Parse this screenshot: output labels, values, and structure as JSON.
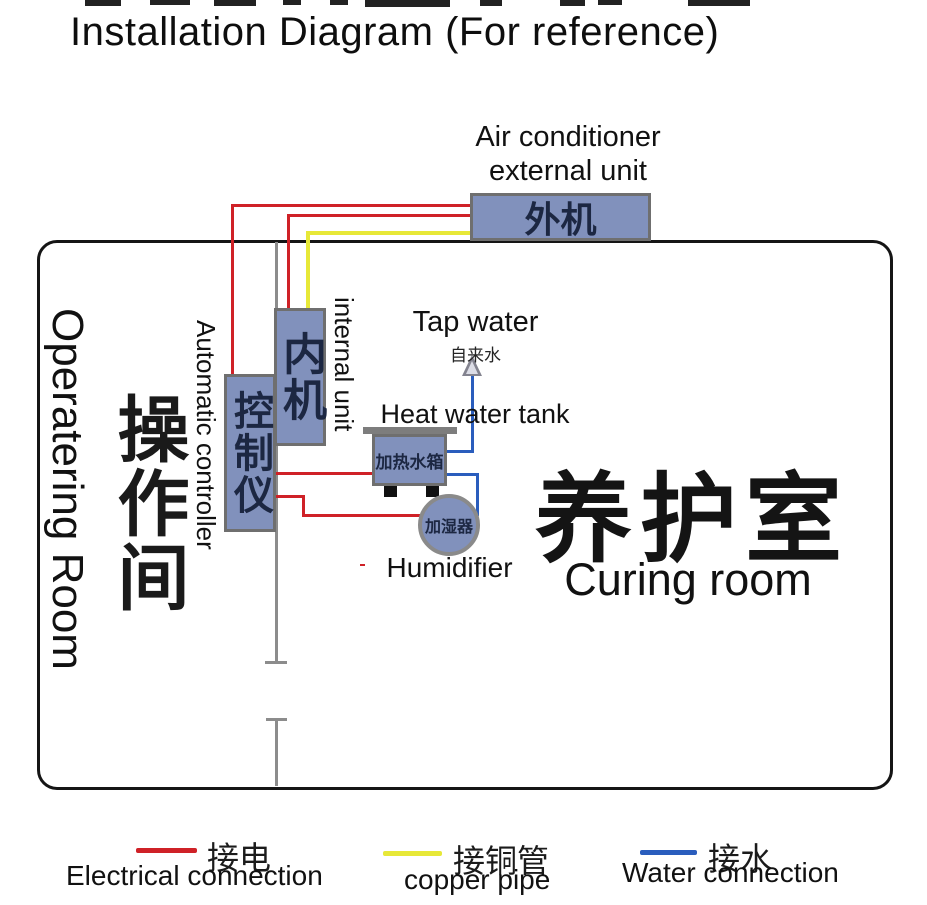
{
  "title": "Installation Diagram (For reference)",
  "colors": {
    "electrical": "#cf2127",
    "copper_pipe": "#e7e838",
    "water": "#2a5dbd",
    "component_fill": "#8191bc",
    "component_border": "#6f6f6f",
    "component_text": "#1c2742",
    "wall": "#151515",
    "partition": "#8c8c8c"
  },
  "external_unit": {
    "caption_line1": "Air conditioner",
    "caption_line2": "external unit",
    "label_zh": "外机"
  },
  "rooms": {
    "operating": {
      "label_en": "Operatering Room",
      "label_zh": "操作间"
    },
    "curing": {
      "label_zh": "养护室",
      "label_en": "Curing room"
    }
  },
  "components": {
    "controller": {
      "label_en": "Automatic controller",
      "label_zh": "控制仪"
    },
    "internal_unit": {
      "label_en": "internal unit",
      "label_zh": "内机"
    },
    "tap_water": {
      "label_en": "Tap water",
      "label_zh": "自来水"
    },
    "heat_water_tank": {
      "label_en": "Heat water tank",
      "label_zh": "加热水箱"
    },
    "humidifier": {
      "label_en": "Humidifier",
      "label_zh": "加湿器"
    }
  },
  "legend": [
    {
      "color": "#cf2127",
      "label_zh": "接电",
      "label_en": "Electrical connection"
    },
    {
      "color": "#e7e838",
      "label_zh": "接铜管",
      "label_en": "copper pipe"
    },
    {
      "color": "#2a5dbd",
      "label_zh": "接水",
      "label_en": "Water connection"
    }
  ]
}
